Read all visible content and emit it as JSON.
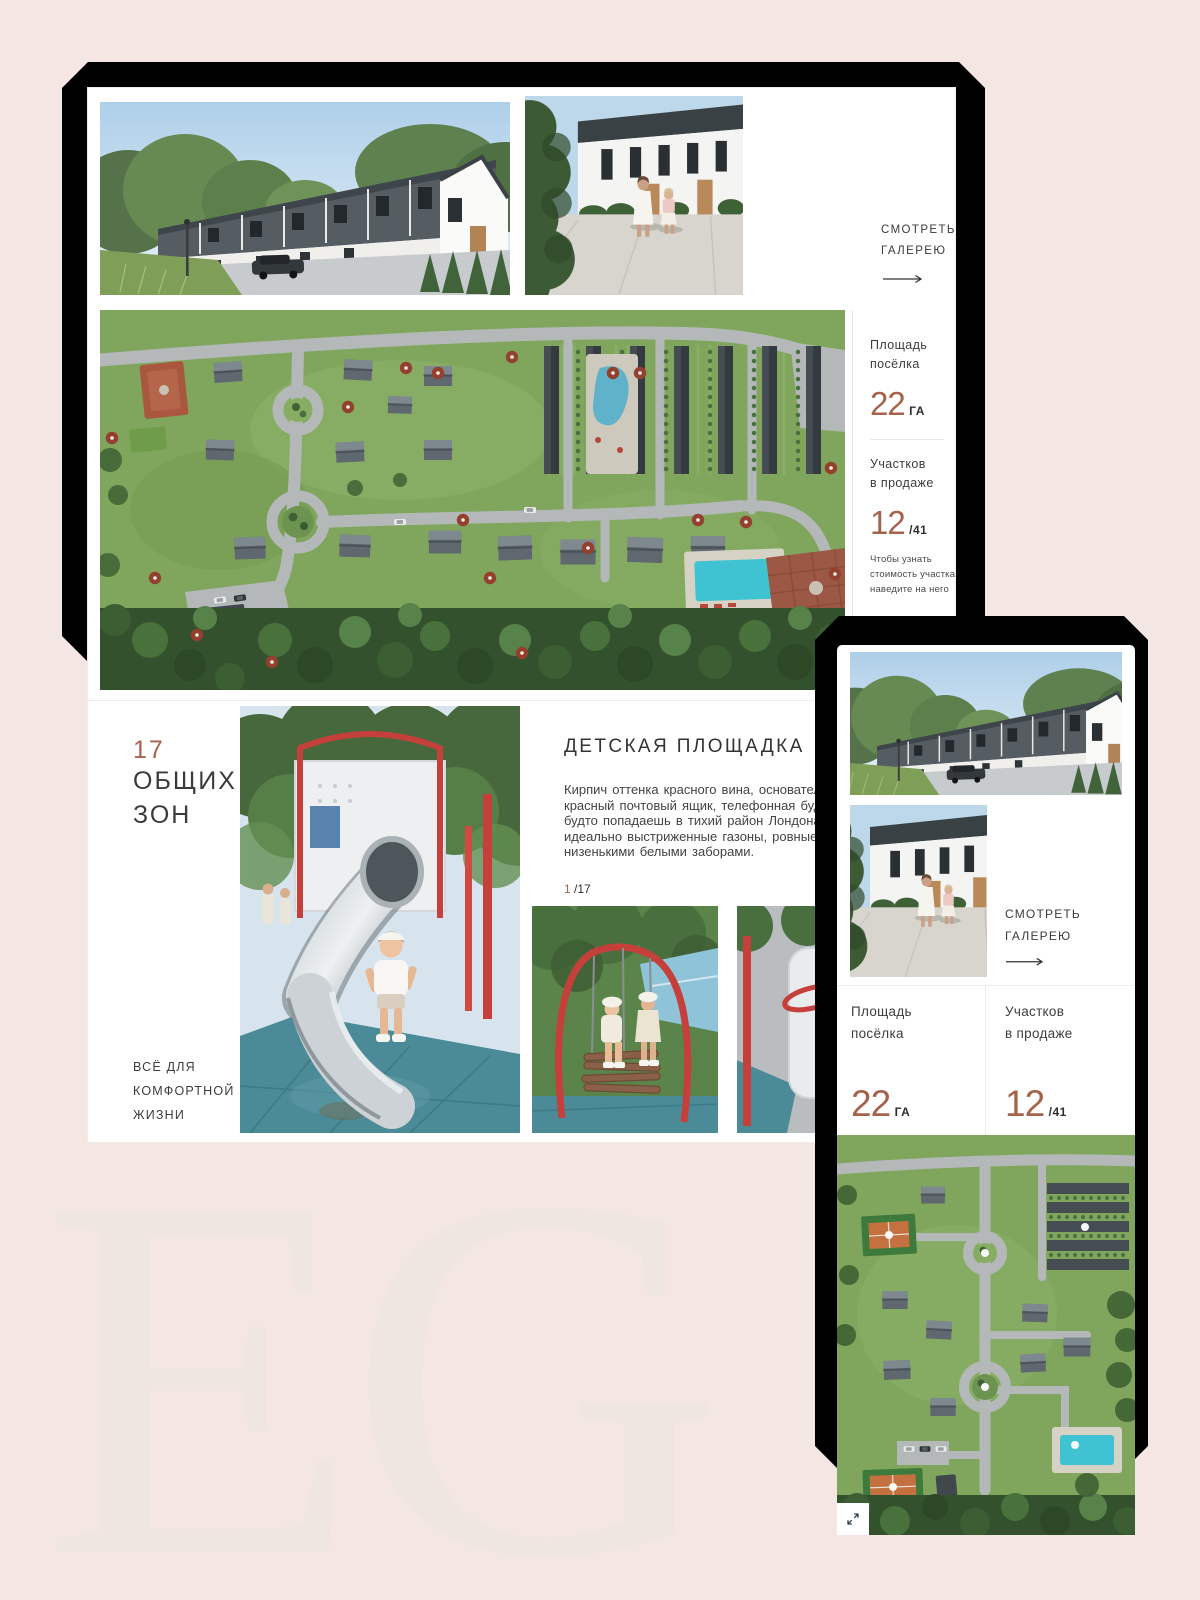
{
  "brand_watermark": "EG",
  "colors": {
    "accent": "#a5634c",
    "background": "#f4e7e3"
  },
  "desktop": {
    "gallery": {
      "see_gallery_line1": "СМОТРЕТЬ",
      "see_gallery_line2": "ГАЛЕРЕЮ"
    },
    "masterplan": {
      "area_label_line1": "Площадь",
      "area_label_line2": "посёлка",
      "area_value": "22",
      "area_unit": "ГА",
      "plots_label_line1": "Участков",
      "plots_label_line2": "в продаже",
      "plots_value": "12",
      "plots_total": "/41",
      "hint": "Чтобы узнать стоимость участка наведите на него"
    },
    "zones": {
      "count": "17",
      "title_line1": "ОБЩИХ",
      "title_line2": "ЗОН",
      "tagline_line1": "ВСЁ ДЛЯ",
      "tagline_line2": "КОМФОРТНОЙ",
      "tagline_line3": "ЖИЗНИ",
      "article_title": "ДЕТСКАЯ ПЛОЩАДКА",
      "article_l1": "Кирпич оттенка красного вина, основательный",
      "article_l2": "красный почтовый ящик, телефонная будка и адрес",
      "article_l3": "будто попадаешь в тихий район Лондона. А",
      "article_l4": "идеально выстриженные газоны, ровные живые",
      "article_l5": "низенькими белыми заборами.",
      "page_current": "1",
      "page_total": "/17"
    }
  },
  "mobile": {
    "see_gallery_line1": "СМОТРЕТЬ",
    "see_gallery_line2": "ГАЛЕРЕЮ",
    "area_label_line1": "Площадь",
    "area_label_line2": "посёлка",
    "area_value": "22",
    "area_unit": "ГА",
    "plots_label_line1": "Участков",
    "plots_label_line2": "в продаже",
    "plots_value": "12",
    "plots_total": "/41"
  }
}
